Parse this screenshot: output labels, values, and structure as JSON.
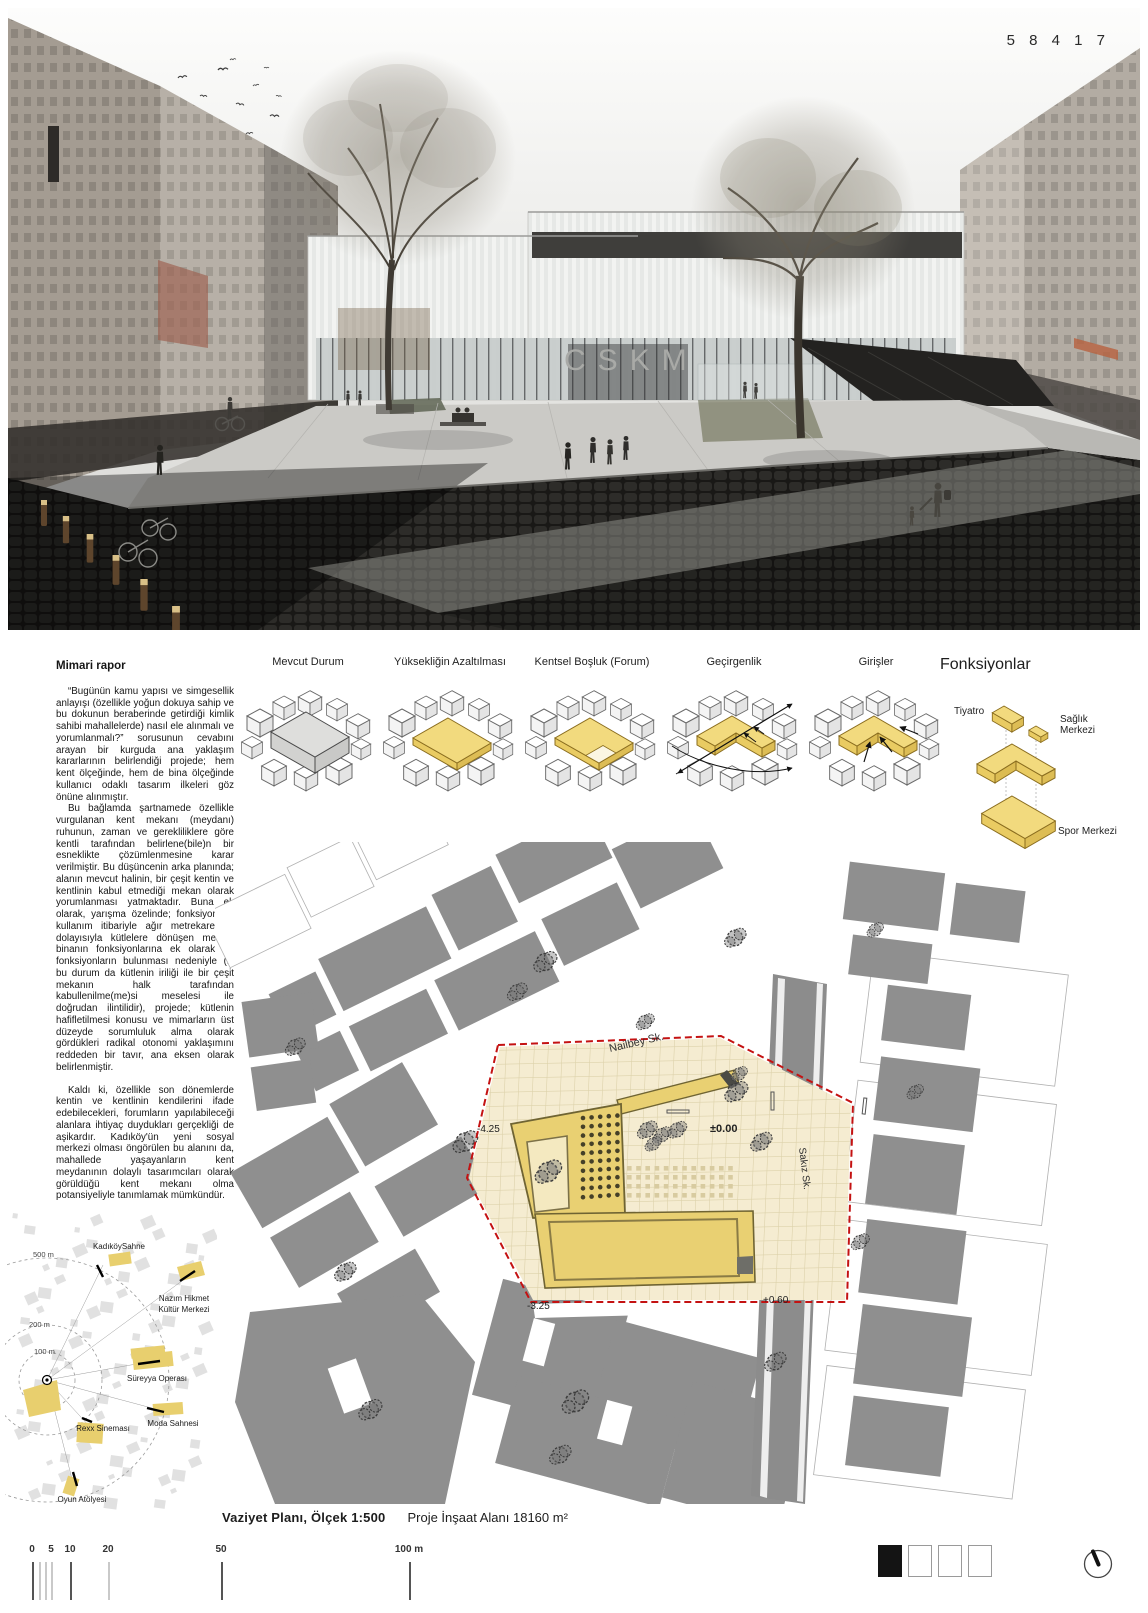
{
  "code": "5 8 4 1 7",
  "hero": {
    "sign": "CSKM"
  },
  "report": {
    "title": "Mimari rapor",
    "p1": "“Bugünün kamu yapısı ve simgesellik anlayışı (özellikle yoğun dokuya sahip ve bu dokunun beraberinde getirdiği kimlik sahibi mahallelerde) nasıl ele alınmalı ve yorumlanmalı?” sorusunun cevabını arayan bir kurguda ana yaklaşım kararlarının belirlendiği projede; hem kent ölçeğinde, hem de bina ölçeğinde kullanıcı odaklı tasarım ilkeleri göz önüne alınmıştır.",
    "p2": "Bu bağlamda şartnamede özellikle vurgulanan kent mekanı (meydanı) ruhunun, zaman ve gerekliliklere göre kentli tarafından belirlene(bile)n bir esneklikte çözümlenmesine karar verilmiştir. Bu düşüncenin arka planında; alanın mevcut halinin, bir çeşit kentin ve kentlinin kabul etmediği mekan olarak yorumlanması yatmaktadır. Buna ek olarak, yarışma özelinde; fonksiyon ve kullanım itibariyle ağır metrekarelere, dolayısıyla kütlelere dönüşen mevcut binanın fonksiyonlarına ek olarak da fonksiyonların bulunması nedeniyle (ki bu durum da kütlenin iriliği ile bir çeşit mekanın halk tarafından kabullenilme(me)si meselesi ile doğrudan ilintilidir), projede; kütlenin hafifletilmesi konusu ve mimarların üst düzeyde sorumluluk alma olarak gördükleri radikal otonomi yaklaşımını reddeden bir tavır, ana eksen olarak belirlenmiştir.",
    "p3": "Kaldı ki, özellikle son dönemlerde kentin ve kentlinin kendilerini ifade edebilecekleri, forumların yapılabileceği alanlara ihtiyaç duydukları gerçekliği de aşikardır. Kadıköy'ün yeni sosyal merkezi olması öngörülen bu alanını da, mahallede yaşayanların kent meydanının dolaylı tasarımcıları olarak görüldüğü kent mekanı olma potansiyeliyle tanımlamak mümkündür."
  },
  "diagrams": {
    "labels": [
      "Mevcut Durum",
      "Yüksekliğin Azaltılması",
      "Kentsel Boşluk (Forum)",
      "Geçirgenlik",
      "Girişler",
      "Fonksiyonlar"
    ],
    "functions": {
      "tiyatro": "Tiyatro",
      "saglik1": "Sağlık",
      "saglik2": "Merkezi",
      "spor": "Spor Merkezi"
    }
  },
  "site_plan": {
    "street_top": "Nailbey Sk.",
    "street_right": "Sakız Sk.",
    "level_a": "-4.25",
    "level_b": "±0.00",
    "level_c": "-3.25",
    "level_d": "+0.60"
  },
  "mini_map": {
    "r500": "500 m",
    "r200": "200 m",
    "r100": "100 m",
    "venue_1": "KadıköySahne",
    "venue_2a": "Nazım Hikmet",
    "venue_2b": "Kültür Merkezi",
    "venue_3": "Süreyya Operası",
    "venue_4": "Rexx Sineması",
    "venue_5": "Moda Sahnesi",
    "venue_6": "Oyun Atölyesi"
  },
  "caption": {
    "title": "Vaziyet Planı, Ölçek 1:500",
    "area": "Proje İnşaat Alanı 18160 m²"
  },
  "scale_bar": {
    "t0": "0",
    "t5": "5",
    "t10": "10",
    "t20": "20",
    "t50": "50",
    "t100": "100 m"
  },
  "colors": {
    "accent_yellow": "#e9d072",
    "plaza": "#f5ecd1",
    "red_boundary": "#c41212",
    "building_gray": "#8f8f8f"
  }
}
